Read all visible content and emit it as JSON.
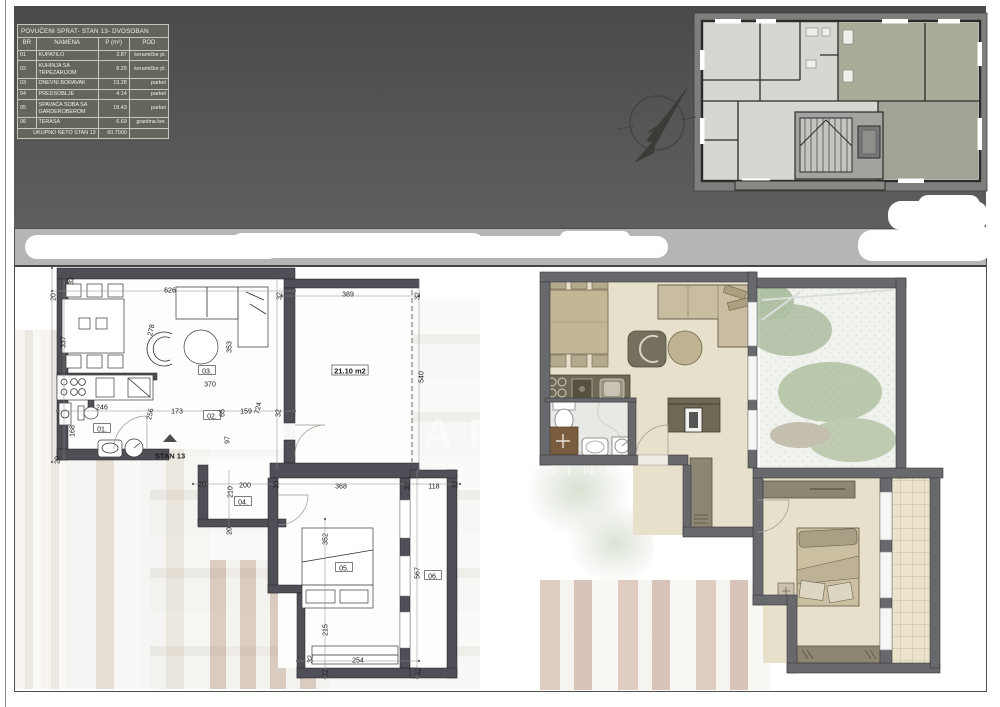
{
  "sheet": {
    "watermark_line1": "ARTE",
    "watermark_line2": "NEKRETNINE"
  },
  "table": {
    "title": "POVUČENI SPRAT- STAN 13- DVOSOBAN",
    "headers": [
      "BR",
      "NAMENA",
      "P (m²)",
      "POD"
    ],
    "rows": [
      {
        "br": "01",
        "namena": "KUPATILO",
        "p": "3.87",
        "pod": "keramičke pl."
      },
      {
        "br": "02",
        "namena": "KUHINJA SA TRPEZARIJOM",
        "p": "8.29",
        "pod": "keramičke pl."
      },
      {
        "br": "03",
        "namena": "DNEVNI BORAVAK",
        "p": "19.28",
        "pod": "parket"
      },
      {
        "br": "04",
        "namena": "PREDSOBLJE",
        "p": "4.14",
        "pod": "parket"
      },
      {
        "br": "05",
        "namena": "SPAVAĆA SOBA SA GARDEROBEROM",
        "p": "18.43",
        "pod": "parket"
      },
      {
        "br": "06",
        "namena": "TERASA",
        "p": "6.69",
        "pod": "granitna ker."
      }
    ],
    "total_label": "UKUPNO NETO STAN 13",
    "total_value": "60.7000"
  },
  "left_plan": {
    "apartment_label": "STAN 13",
    "terrace_area_label": "21.10 m2",
    "annotations": [
      {
        "t": "32",
        "x": 71,
        "y": 281,
        "r": -90
      },
      {
        "t": "20",
        "x": 53,
        "y": 297,
        "r": -90
      },
      {
        "t": "626",
        "x": 170,
        "y": 290
      },
      {
        "t": "337",
        "x": 63,
        "y": 342,
        "r": -90
      },
      {
        "t": "278",
        "x": 151,
        "y": 330,
        "r": -78
      },
      {
        "t": "353",
        "x": 229,
        "y": 347,
        "r": -90
      },
      {
        "t": "389",
        "x": 348,
        "y": 294
      },
      {
        "t": "32",
        "x": 279,
        "y": 296,
        "r": -90
      },
      {
        "t": "32",
        "x": 417,
        "y": 296,
        "r": -90
      },
      {
        "t": "540",
        "x": 421,
        "y": 377,
        "r": -90
      },
      {
        "t": "370",
        "x": 210,
        "y": 384
      },
      {
        "t": "03.",
        "x": 207,
        "y": 371,
        "box": 1
      },
      {
        "t": "02.",
        "x": 212,
        "y": 416,
        "box": 1
      },
      {
        "t": "246",
        "x": 102,
        "y": 407
      },
      {
        "t": "256",
        "x": 150,
        "y": 414,
        "r": -78
      },
      {
        "t": "173",
        "x": 177,
        "y": 411
      },
      {
        "t": "65",
        "x": 222,
        "y": 413,
        "r": -90
      },
      {
        "t": "159",
        "x": 246,
        "y": 411
      },
      {
        "t": "724",
        "x": 258,
        "y": 408,
        "r": -78
      },
      {
        "t": "32",
        "x": 278,
        "y": 413,
        "r": -90
      },
      {
        "t": "97",
        "x": 227,
        "y": 440,
        "r": -90
      },
      {
        "t": "01.",
        "x": 102,
        "y": 429,
        "box": 1
      },
      {
        "t": "168",
        "x": 72,
        "y": 431,
        "r": -90
      },
      {
        "t": "20",
        "x": 57,
        "y": 460,
        "r": -90
      },
      {
        "t": "STAN 13",
        "x": 170,
        "y": 456,
        "stan": 1
      },
      {
        "t": "20",
        "x": 202,
        "y": 484
      },
      {
        "t": "210",
        "x": 230,
        "y": 492,
        "r": -90
      },
      {
        "t": "200",
        "x": 245,
        "y": 485
      },
      {
        "t": "04.",
        "x": 243,
        "y": 502,
        "box": 1
      },
      {
        "t": "10",
        "x": 276,
        "y": 485,
        "r": -90
      },
      {
        "t": "368",
        "x": 341,
        "y": 486
      },
      {
        "t": "32",
        "x": 407,
        "y": 486,
        "r": -90
      },
      {
        "t": "118",
        "x": 434,
        "y": 486
      },
      {
        "t": "32",
        "x": 455,
        "y": 485,
        "r": -90
      },
      {
        "t": "20",
        "x": 229,
        "y": 531,
        "r": -90
      },
      {
        "t": "352",
        "x": 325,
        "y": 539,
        "r": -90
      },
      {
        "t": "05.",
        "x": 344,
        "y": 568,
        "box": 1
      },
      {
        "t": "567",
        "x": 417,
        "y": 573,
        "r": -90
      },
      {
        "t": "06.",
        "x": 433,
        "y": 576,
        "box": 1
      },
      {
        "t": "215",
        "x": 325,
        "y": 630,
        "r": -90
      },
      {
        "t": "254",
        "x": 358,
        "y": 660
      },
      {
        "t": "32",
        "x": 310,
        "y": 659,
        "r": -90
      },
      {
        "t": "32",
        "x": 325,
        "y": 673,
        "r": -90
      },
      {
        "t": "32",
        "x": 418,
        "y": 672,
        "r": -90
      },
      {
        "t": "21.10 m2",
        "x": 350,
        "y": 371,
        "box": 1,
        "big": 1
      }
    ]
  },
  "icons": {
    "north_arrow": "compass-north-arrow"
  },
  "colors": {
    "header_band": "#4f4f4f",
    "table_fill": "#62665c",
    "table_text": "#f1f1e8",
    "strip_band": "#b5b6b3",
    "wall_line_plan": "#4f5057",
    "wall_render_plan": "#68696d",
    "floor_beige": "#e7e0cb",
    "furniture_olive": "#6e6854",
    "furniture_tan": "#cabfa0",
    "highlight_green": "#a8ad9a",
    "terrace_tile": "#ebe3cb"
  }
}
